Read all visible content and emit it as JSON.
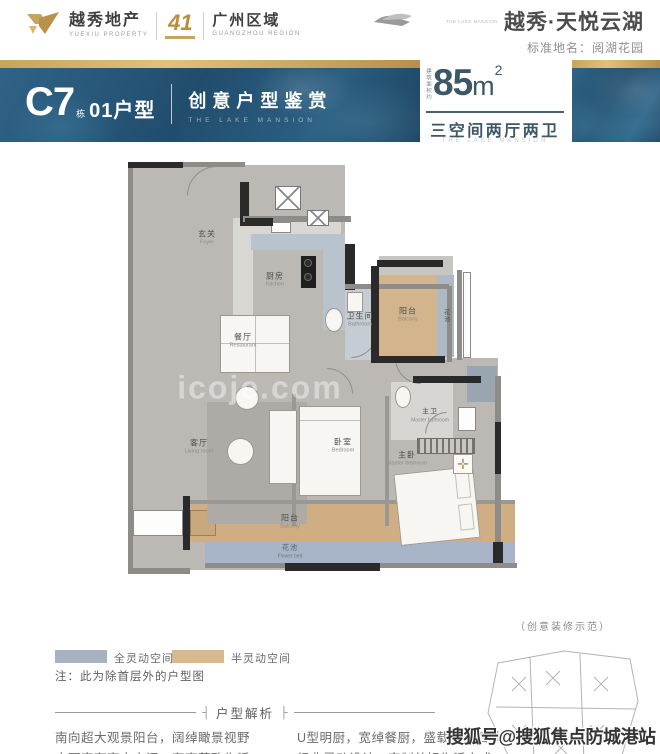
{
  "header": {
    "left": {
      "name": "越秀地产",
      "name_en": "YUEXIU PROPERTY",
      "anniversary": "41",
      "region": "广州区域",
      "region_en": "GUANGZHOU REGION"
    },
    "right": {
      "project": "越秀·天悦云湖",
      "logo_caption": "THE LAKE MANSION",
      "subtitle": "标准地名：阅湖花园"
    }
  },
  "banner": {
    "unit_code": "C7",
    "unit_code_suffix": "栋",
    "unit_type": "01户型",
    "slogan": "创意户型鉴赏",
    "slogan_en": "THE LAKE MANSION",
    "area_label": "建筑面积约",
    "area_value": "85",
    "area_unit": "m",
    "area_sup": "2",
    "layout": "三空间两厅两卫",
    "layout_en": "THE LAKE MANSION"
  },
  "floorplan": {
    "watermark": "icoje.com",
    "rooms": [
      {
        "name": "玄关",
        "en": "Foyer"
      },
      {
        "name": "厨房",
        "en": "Kitchen"
      },
      {
        "name": "卫生间",
        "en": "Bathroom"
      },
      {
        "name": "餐厅",
        "en": "Restaurant"
      },
      {
        "name": "阳台",
        "en": "Balcony"
      },
      {
        "name": "花池",
        "en": "Flower bed"
      },
      {
        "name": "客厅",
        "en": "Living room"
      },
      {
        "name": "卧室",
        "en": "Bedroom"
      },
      {
        "name": "主卫",
        "en": "Master bathroom"
      },
      {
        "name": "主卧",
        "en": "Master bedroom"
      },
      {
        "name": "阳台",
        "en": "Balcony"
      },
      {
        "name": "花池",
        "en": "Flower bed"
      }
    ]
  },
  "legend": {
    "full_flex": {
      "label": "全灵动空间",
      "color": "#a9b2c1"
    },
    "half_flex": {
      "label": "半灵动空间",
      "color": "#d6b98c"
    },
    "note": "注：此为除首层外的户型图"
  },
  "deco": {
    "label": "（创意装修示范）"
  },
  "analysis": {
    "title": "户型解析",
    "bracket_l": "┤",
    "bracket_r": "├",
    "rows": [
      {
        "left": "南向超大观景阳台，阔绰瞰景视野",
        "right": "U型明厨，宽绰餐厨，盛载三餐四季"
      },
      {
        "left": "大面宽奢享大空间，奢享菁致生活",
        "right": "经典灵动设计，定制美好生活方式"
      }
    ]
  },
  "icons": {
    "compass": "✛"
  },
  "site_watermark": "搜狐号@搜狐焦点防城港站",
  "colors": {
    "gold": "#c9a45c",
    "banner_blue": "#2a5a7d",
    "teal_text": "#3d5766",
    "flex_full": "#a9b2c1",
    "flex_half": "#d6b98c"
  }
}
